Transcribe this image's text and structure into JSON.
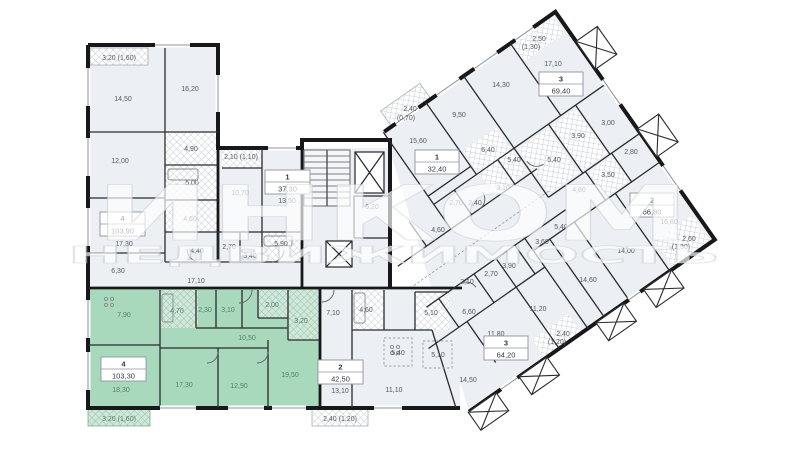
{
  "watermark": {
    "line1": "ИНКОМ",
    "line2": "НЕДВИЖИМОСТЬ"
  },
  "colors": {
    "wall": "#17181a",
    "room_fill": "#eceff3",
    "highlight_fill": "#a8d9bc",
    "hatch_line": "#c9cdd4",
    "label": "#555b63",
    "label_highlight": "#56806a"
  },
  "apartments": [
    {
      "number": "4",
      "area": "103,90",
      "balcony": "3,20 (1,60)",
      "rooms": [
        "14,50",
        "16,20",
        "12,00",
        "4,90",
        "5,00",
        "4,60",
        "4,40",
        "17,30",
        "6,30",
        "17,10"
      ]
    },
    {
      "number": "1",
      "area": "37,30",
      "balcony": "2,10 (1,10)",
      "rooms": [
        "13,50",
        "10,70",
        "5,90",
        "2,70",
        "3,40"
      ]
    },
    {
      "number": "4",
      "area": "103,30",
      "balcony": "3,20 (1,60)",
      "highlighted": true,
      "rooms": [
        "7,90",
        "4,70",
        "2,30",
        "3,10",
        "2,00",
        "3,20",
        "10,50",
        "18,30",
        "17,30",
        "12,90",
        "19,50"
      ]
    },
    {
      "number": "2",
      "area": "42,50",
      "balcony": "2,40 (1,20)",
      "rooms": [
        "7,10",
        "4,60",
        "5,40",
        "13,10",
        "11,10"
      ]
    },
    {
      "number": "1",
      "area": "32,40",
      "balcony_line1": "2,40",
      "balcony_line2": "(0,70)",
      "rooms": [
        "15,60",
        "9,50",
        "6,20"
      ]
    },
    {
      "number": "3",
      "area": "69,40",
      "balcony_line1": "2,50",
      "balcony_line2": "(1,30)",
      "rooms": [
        "17,10",
        "14,30",
        "6,40",
        "5,40",
        "3,10",
        "5,40",
        "3,90",
        "3,00"
      ]
    },
    {
      "number": "2",
      "area": "66,80",
      "balcony_line1": "2,60",
      "balcony_line2": "(1,30)",
      "rooms": [
        "16,80",
        "14,00",
        "14,60",
        "2,80",
        "3,50",
        "4,80"
      ]
    },
    {
      "number": "3",
      "area": "64,20",
      "balcony_line1": "2,40",
      "balcony_line2": "(1,20)",
      "rooms": [
        "11,80",
        "11,20",
        "14,50",
        "6,60",
        "2,10",
        "2,70",
        "3,90",
        "3,60",
        "5,40",
        "5,10",
        "5,10",
        "4,60",
        "2,70",
        "2,40"
      ]
    }
  ]
}
